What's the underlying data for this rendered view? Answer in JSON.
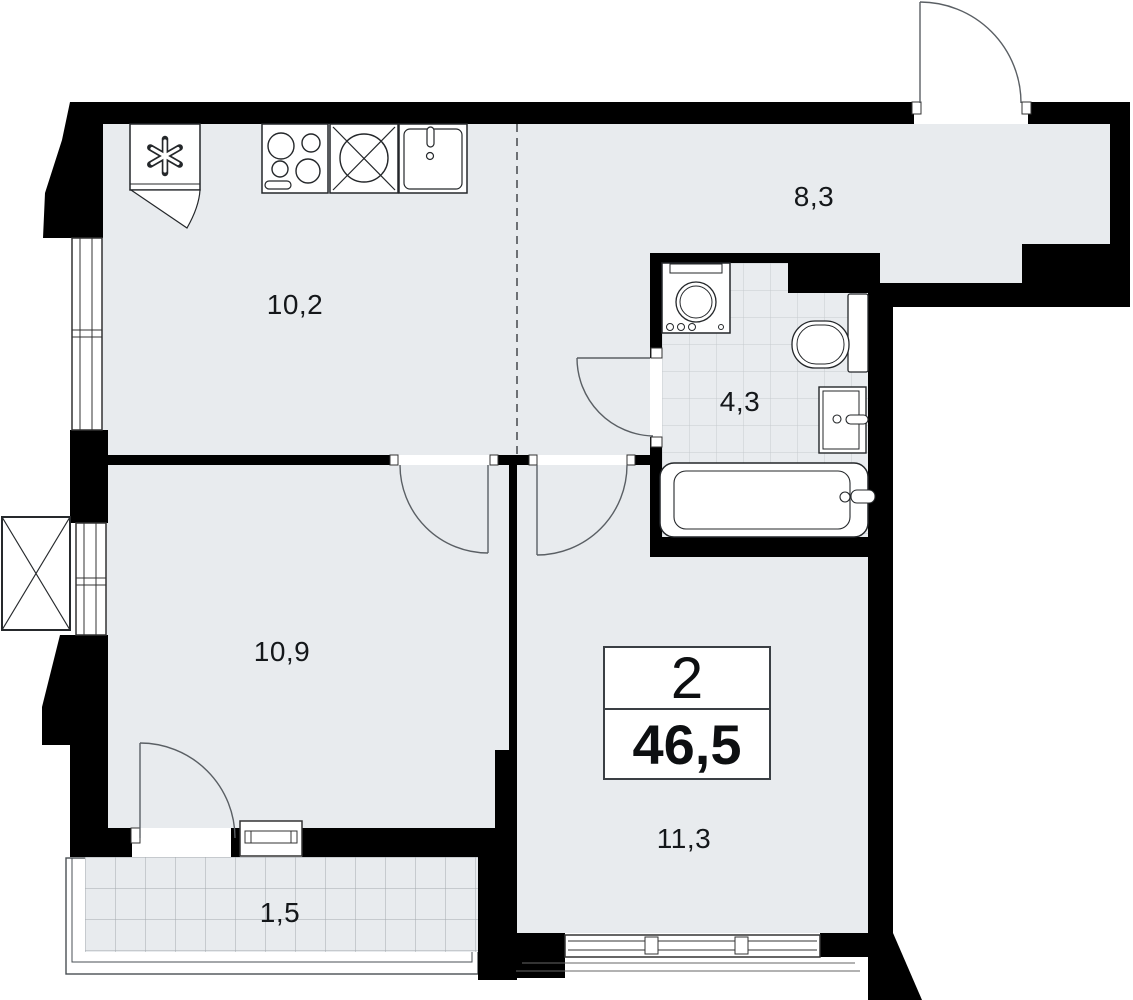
{
  "summary": {
    "rooms_count": "2",
    "total_area": "46,5"
  },
  "rooms": [
    {
      "name": "kitchen",
      "area": "10,2"
    },
    {
      "name": "hallway",
      "area": "8,3"
    },
    {
      "name": "bathroom",
      "area": "4,3"
    },
    {
      "name": "bedroom",
      "area": "10,9"
    },
    {
      "name": "living-room",
      "area": "11,3"
    },
    {
      "name": "balcony",
      "area": "1,5"
    }
  ],
  "icons": [
    "refrigerator-icon",
    "stove-icon",
    "sink-crossed-icon",
    "kitchen-sink-icon",
    "washing-machine-icon",
    "toilet-icon",
    "wash-basin-icon",
    "bathtub-icon",
    "entrance-door-icon",
    "interior-door-icon",
    "balcony-door-icon",
    "window-icon",
    "ac-basket-icon"
  ],
  "colors": {
    "wall": "#000000",
    "floor": "#e8ebee",
    "bathroom_floor": "#e9ecef",
    "background": "#ffffff",
    "outline": "#2a2a2a"
  }
}
